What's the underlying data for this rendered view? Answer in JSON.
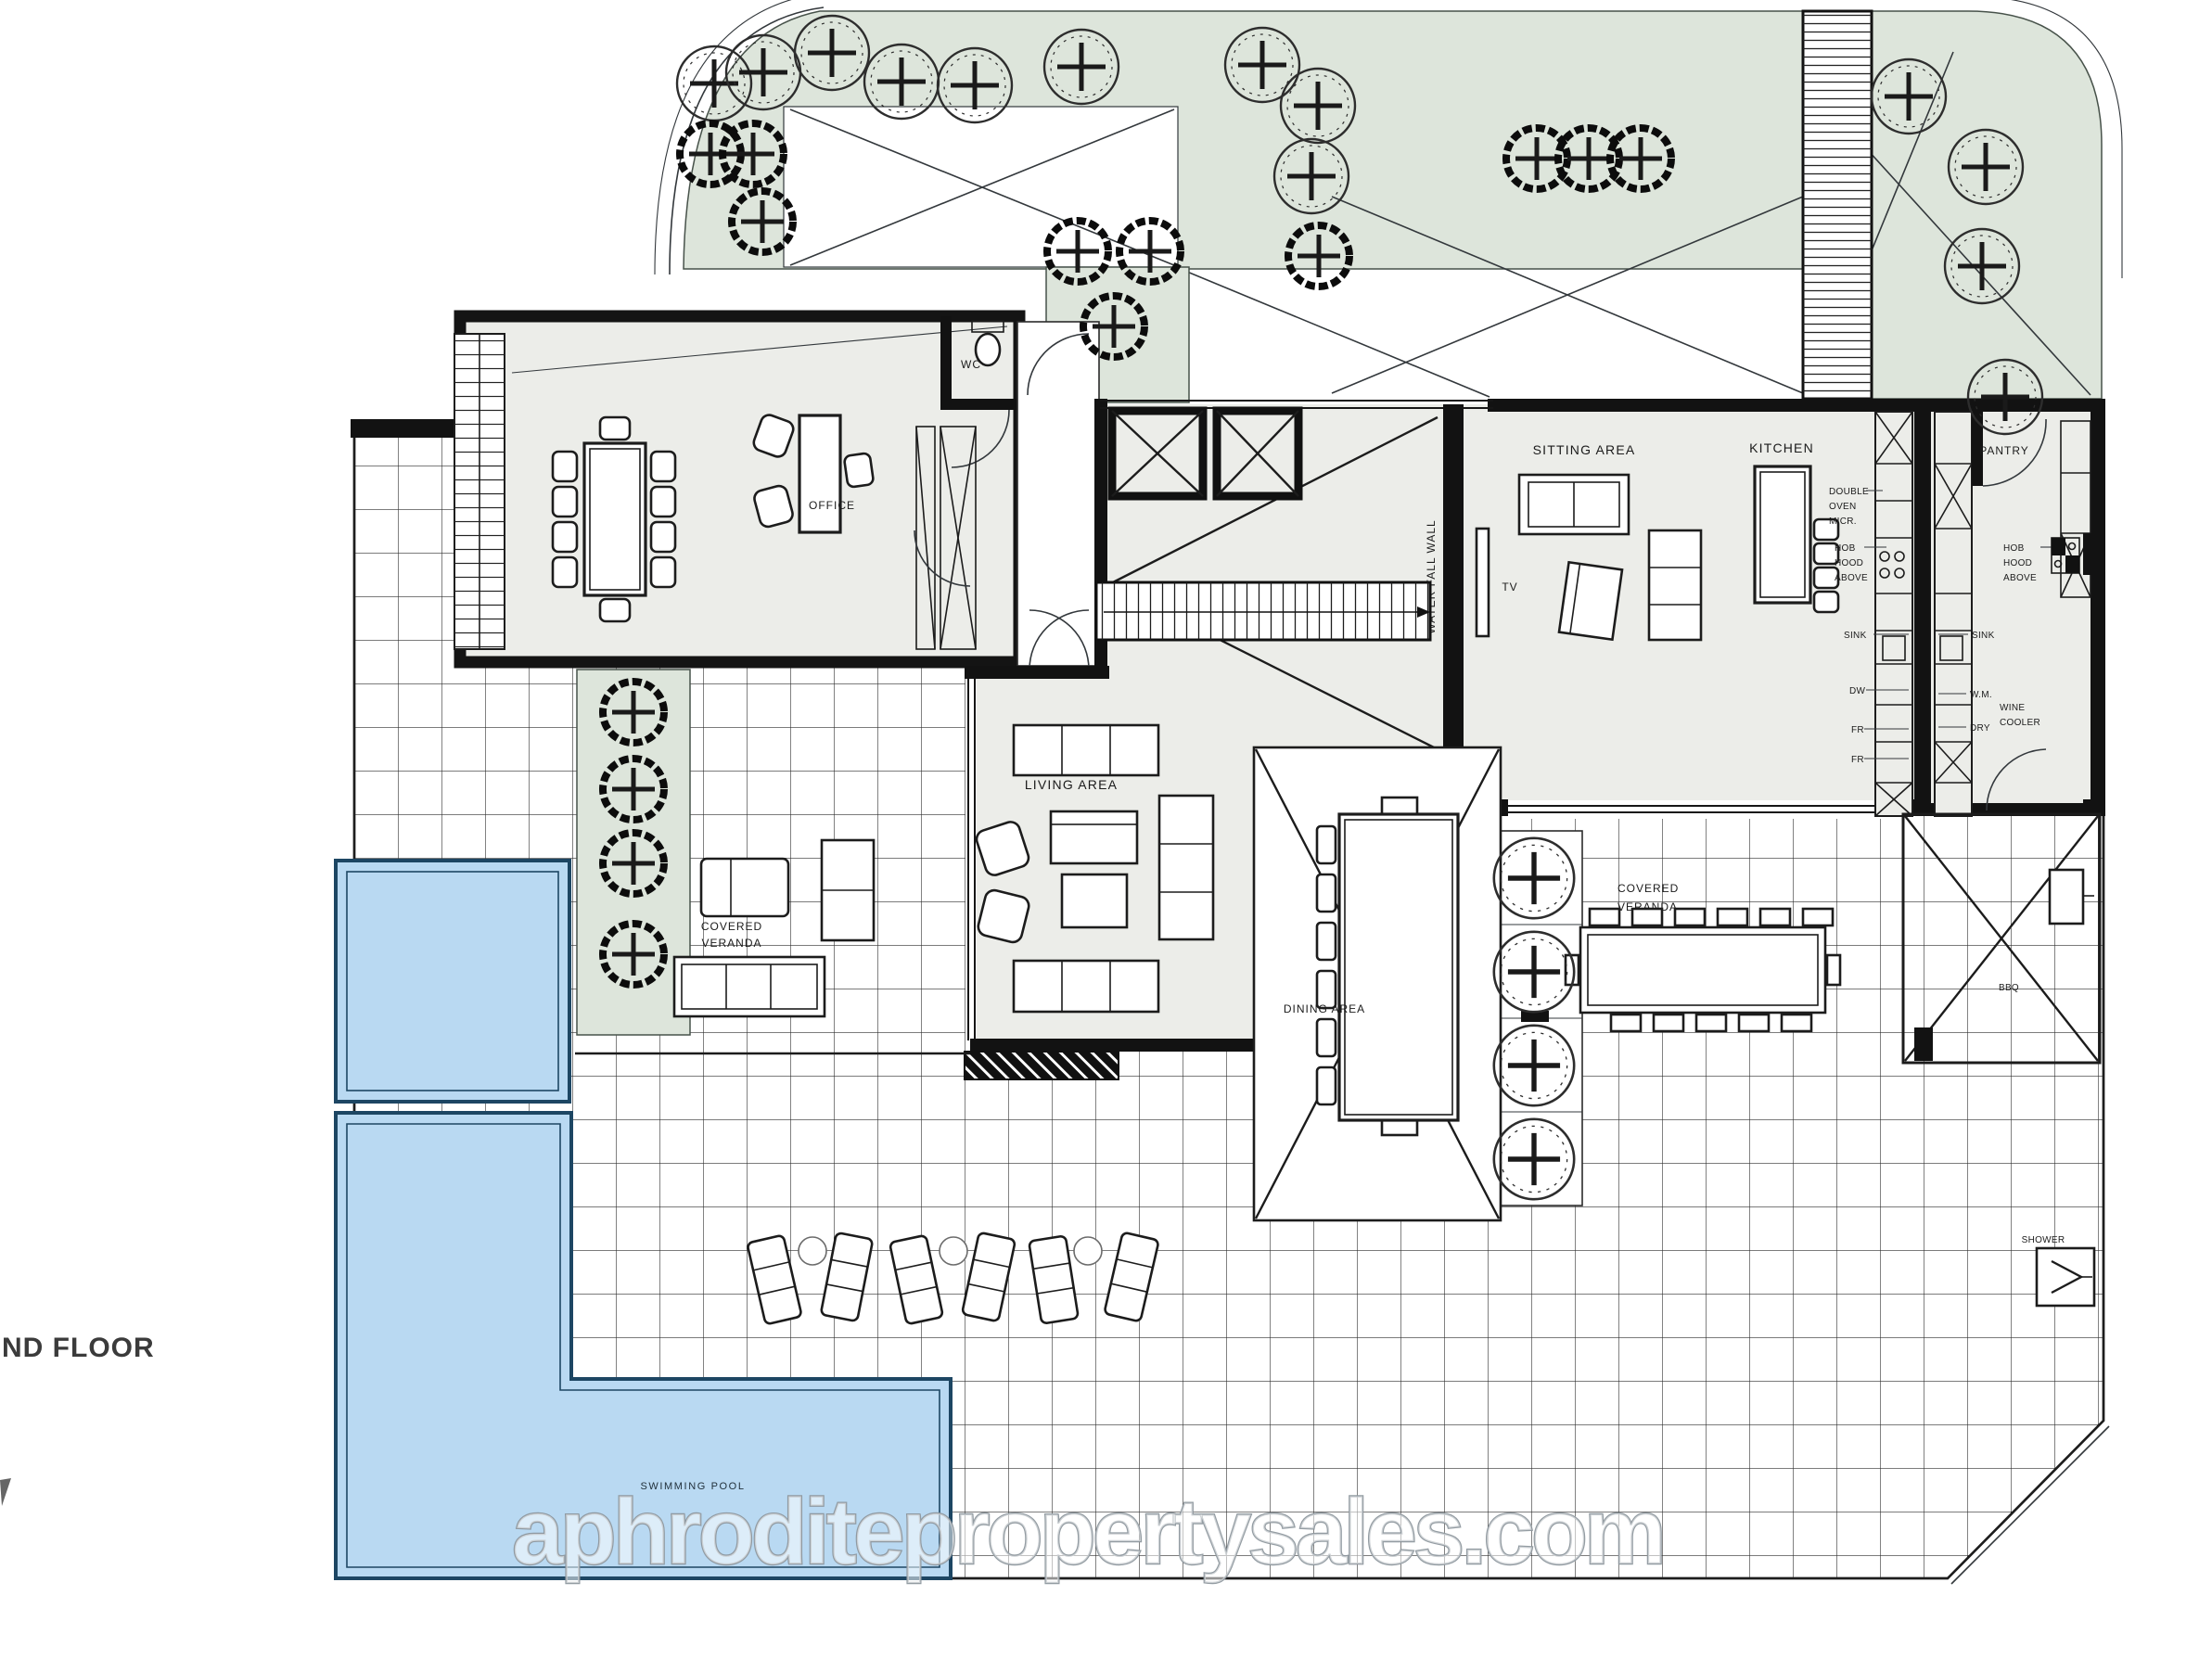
{
  "page": {
    "floor_label": "ND FLOOR",
    "watermark": "aphroditepropertysales.com"
  },
  "rooms": {
    "office": "OFFICE",
    "wc": "WC",
    "sitting_area": "SITTING AREA",
    "kitchen": "KITCHEN",
    "pantry": "PANTRY",
    "tv": "TV",
    "water_fall_wall": "WATER FALL WALL",
    "living_area": "LIVING AREA",
    "dining_area": "DINING AREA",
    "covered_veranda_left_line1": "COVERED",
    "covered_veranda_left_line2": "VERANDA",
    "covered_veranda_right_line1": "COVERED",
    "covered_veranda_right_line2": "VERANDA",
    "swimming_pool": "SWIMMING POOL",
    "bbq": "BBQ",
    "shower": "SHOWER"
  },
  "fixtures": {
    "double_oven_line1": "DOUBLE",
    "double_oven_line2": "OVEN",
    "double_oven_line3": "MICR.",
    "hob_left_line1": "HOB",
    "hob_left_line2": "HOOD",
    "hob_left_line3": "ABOVE",
    "hob_right_line1": "HOB",
    "hob_right_line2": "HOOD",
    "hob_right_line3": "ABOVE",
    "sink_left": "SINK",
    "sink_right": "SINK",
    "dishwasher": "DW",
    "washing_machine": "W.M.",
    "dryer": "DRY",
    "fridge1": "FR",
    "fridge2": "FR",
    "wine_cooler_line1": "WINE",
    "wine_cooler_line2": "COOLER"
  },
  "colors": {
    "planting": "#dde5db",
    "floor": "#ecede9",
    "wall": "#121212",
    "pool_fill": "#b9d9f2",
    "pool_edge": "#1d4663",
    "watermark_stroke": "#8e979e",
    "watermark_fill": "rgba(255,255,255,0.55)"
  }
}
